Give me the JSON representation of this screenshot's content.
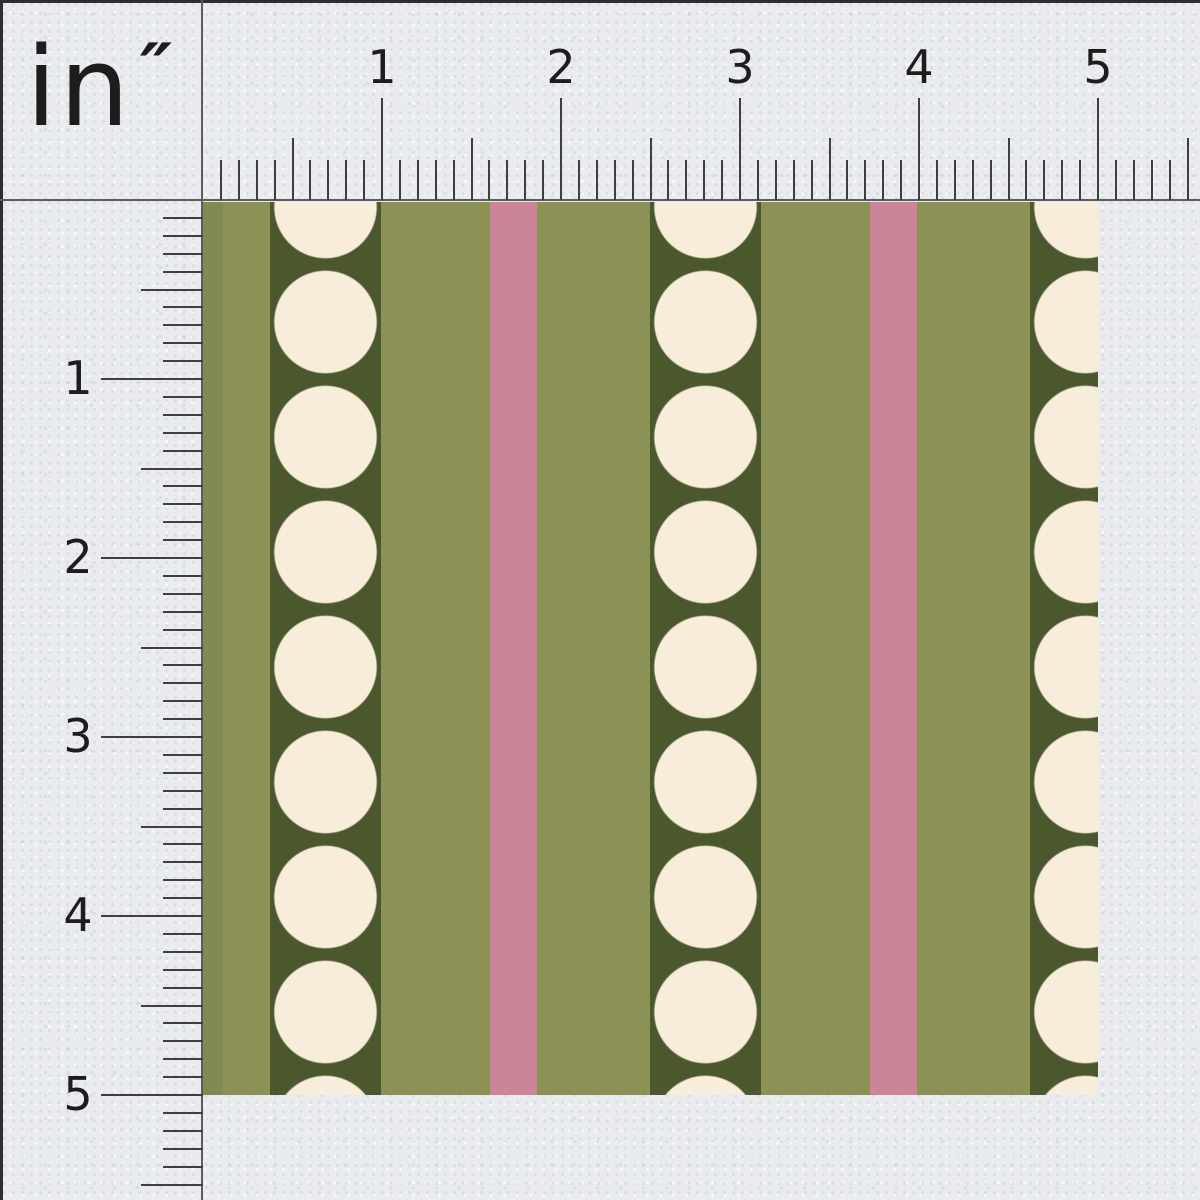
{
  "unit_label": {
    "text": "in",
    "mark": "″"
  },
  "colors": {
    "paper": "#e9ebee",
    "frame": "#2e2e2e",
    "ruler_line": "#5c5c5c",
    "tick": "#3f3f3f",
    "ink": "#1d1d1d",
    "olive": "#8c9155",
    "olive_seam": "#828a52",
    "dark_green": "#4b572c",
    "cream": "#f8ecdb",
    "pink": "#cc8498"
  },
  "rulers": {
    "px_per_inch": 179,
    "minor_per_inch": 10,
    "extent_inches": 5.5,
    "origin_x": 203,
    "origin_y": 200,
    "tick_len_minor": 40,
    "tick_len_half": 62,
    "tick_len_inch": 102,
    "top_numbers": [
      "1",
      "2",
      "3",
      "4",
      "5"
    ],
    "left_numbers": [
      "1",
      "2",
      "3",
      "4",
      "5"
    ]
  },
  "fabric": {
    "left": 203,
    "top": 202,
    "width": 895,
    "height": 893,
    "repeat_x": 380,
    "dark_stripe": {
      "offset": 67,
      "width": 111
    },
    "pink_stripe": {
      "offset": 287,
      "width": 47
    },
    "seam_width": 20,
    "dots": {
      "center_x": 122.5,
      "first_center_y": 5,
      "radius": 52,
      "spacing_y": 115
    }
  },
  "layout": {
    "canvas_w": 1200,
    "canvas_h": 1200,
    "frame_px": 3,
    "line_px": 2
  }
}
